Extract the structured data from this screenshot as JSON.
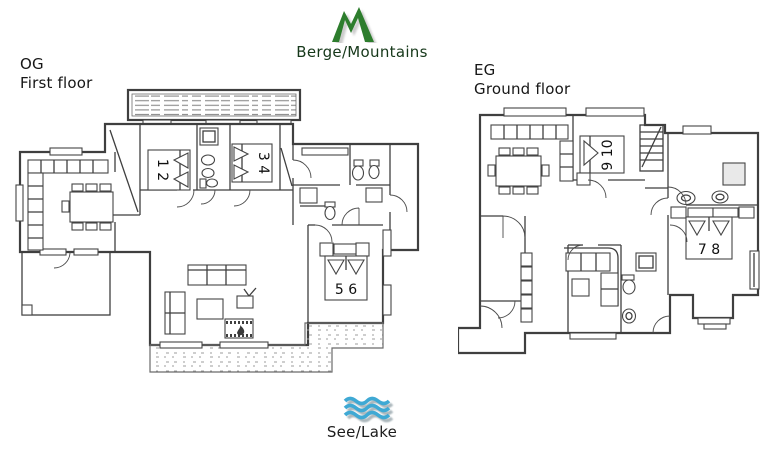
{
  "legend": {
    "mountains_label": "Berge/Mountains",
    "lake_label": "See/Lake",
    "mountain_color": "#2d7d2d",
    "lake_color": "#3fa9d4"
  },
  "og": {
    "code": "OG",
    "name": "First floor",
    "bed12": "1 2",
    "bed34": "3 4",
    "bed56": "5 6"
  },
  "eg": {
    "code": "EG",
    "name": "Ground floor",
    "bed910": "9 10",
    "bed78": "7 8"
  },
  "colors": {
    "line": "#3f3f3f",
    "hatch": "#8d8d8d",
    "background": "#ffffff"
  }
}
